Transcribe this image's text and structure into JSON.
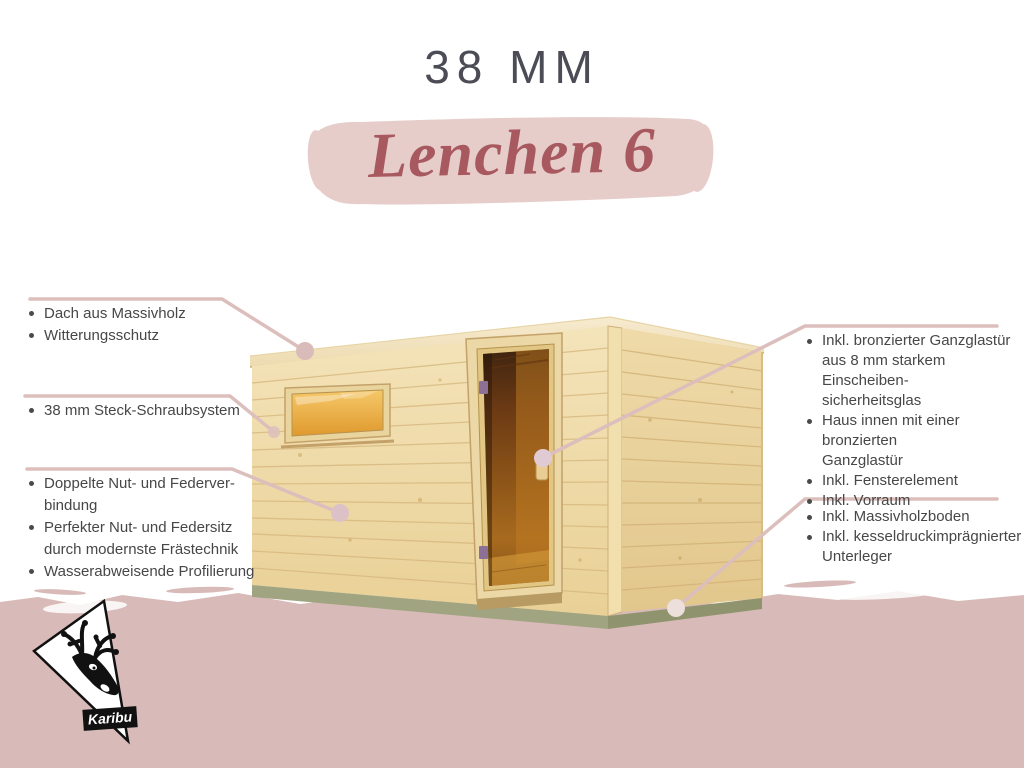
{
  "header": {
    "thickness_label": "38 MM",
    "product_name": "Lenchen 6"
  },
  "callouts": {
    "left": [
      {
        "items": [
          "Dach aus Massivholz",
          "Witterungsschutz"
        ]
      },
      {
        "items": [
          "38 mm Steck-Schraubsystem"
        ]
      },
      {
        "items": [
          "Doppelte Nut- und Federver-\nbindung",
          "Perfekter Nut- und Federsitz\ndurch modernste Frästechnik",
          "Wasserabweisende Profilierung"
        ]
      }
    ],
    "right": [
      {
        "items": [
          "Inkl. bronzierter Ganzglastür\naus 8 mm starkem Einscheiben-\nsicherheitsglas",
          "Haus innen mit einer bronzierten\nGanzglastür",
          "Inkl. Fensterelement",
          "Inkl. Vorraum"
        ]
      },
      {
        "items": [
          "Inkl. Massivholzboden",
          "Inkl. kesseldruckimprägnierter\nUnterleger"
        ]
      }
    ]
  },
  "logo": {
    "brand": "Karibu"
  },
  "colors": {
    "accent_line": "#dcbfbc",
    "brush_stroke": "#e6cdca",
    "bottom_band": "#d8bbb8",
    "title_text": "#4b4c55",
    "product_name_text": "#a8595f",
    "body_text": "#474747",
    "wood_light": "#f2e2b8",
    "glass_amber": "#e8a53f",
    "door_bronze": "#6b3a14",
    "base_olive": "#9fa37e"
  }
}
